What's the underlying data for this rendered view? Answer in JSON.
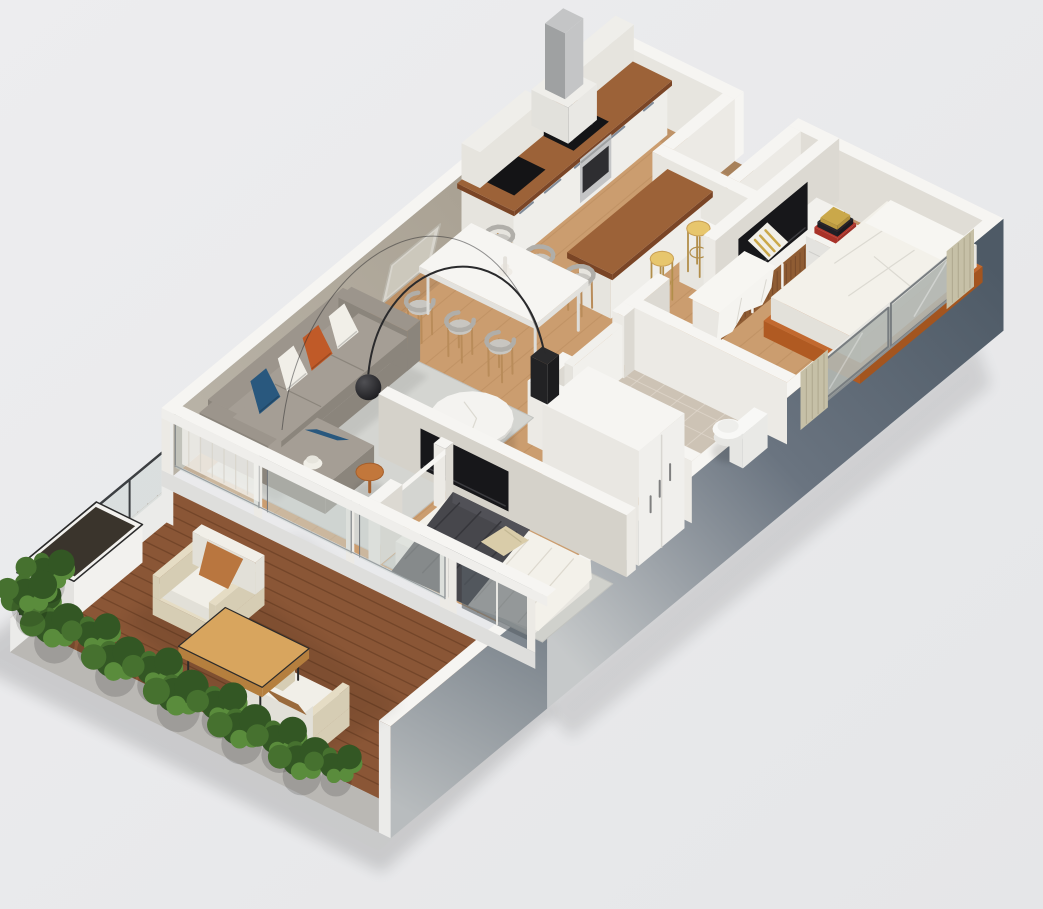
{
  "scene": {
    "title": "Isometric 3D floor plan render of a two-bedroom apartment with wooden terrace",
    "background": "#e8e9ea",
    "colors": {
      "bg1": "#ededef",
      "bg2": "#e5e6e8",
      "cap": "#f6f5f2",
      "beam": "#efeeeb",
      "wall_face_white": "#eceae5",
      "wall_face_warm": "#e7e5df",
      "wall_face_shade": "#e0ddd6",
      "wall_face_inner": "#dcd9d2",
      "tv_wall_face": "#d5d2ca",
      "wall_taupe_1": "#a49b8c",
      "wall_taupe_2": "#b8b2a6",
      "wall_grad_1": "#4e5a66",
      "wall_grad_2": "#6a7480",
      "wall_grad_3": "#c6c9ca",
      "ext_grad_1": "#5f6a75",
      "ext_grad_2": "#b8bcbe",
      "end_face": "#ebebe9",
      "floor_wood": "#cb9d6f",
      "floor_plank": "#b8895b",
      "tile": "#cdc3b5",
      "grout": "#ded6ca",
      "deck": "#8a5636",
      "deck_line": "#61391f",
      "deck_fascia": "#bab8b4",
      "rug_living": "#d4d5d1",
      "rug_bed": "#d0d1cc",
      "rug_edge": "#c2c3bf",
      "sofa": "#9c958c",
      "sofa_dark": "#8b857c",
      "sofa_seat": "#a59e95",
      "pillow_white": "#f1efe8",
      "pillow_orange": "#c05a28",
      "pillow_blue": "#29587e",
      "pillow_beige": "#d9cca9",
      "pillow_tan": "#b9763f",
      "pillow_brown": "#9a6a3c",
      "marble": "#f4f3f0",
      "marble_rim": "#d9d8d4",
      "side_table": "#c2773b",
      "lamp_dark": "#2a2a2c",
      "lamp_hi": "#505054",
      "lamp_lo": "#131316",
      "table_white": "#f6f5f2",
      "table_side": "#e2e1dd",
      "chair_shell": "#b0aea9",
      "chair_seat": "#c8c6c1",
      "leg_wood": "#b98c5a",
      "counter_wood": "#9c6238",
      "counter_dark": "#7a4526",
      "cabinet": "#efeeea",
      "cabinet_side": "#e6e4de",
      "handle": "#647284",
      "steel": "#c4c5c6",
      "steel_dark": "#9fa1a2",
      "appliance_black": "#141416",
      "stool": "#e7c66d",
      "stool_leg": "#b28e4a",
      "bed_white": "#f3f1ea",
      "bed_fold": "#dcdad2",
      "bed_frame": "#c2692f",
      "bed_frame_dark": "#a3551f",
      "blanket": "#47474c",
      "blanket_fold": "#36363b",
      "curtain": "#c6c0a7",
      "curtain_dark": "#aaa389",
      "window_glass": "#b2b6b1",
      "window_frame": "#787d80",
      "glass_pane": "rgba(202,212,209,0.48)",
      "glass_dark": "rgba(88,97,104,0.62)",
      "sheer": "rgba(246,245,241,0.72)",
      "sheer_line": "rgba(215,212,202,0.85)",
      "tv": "#17171a",
      "tv_sheen": "#3c3c40",
      "console_top": "#f2f1ed",
      "rattan": "#8f5c33",
      "rattan_line": "#6f4426",
      "nightstand": "#f4f3ef",
      "book_red": "#b5372c",
      "book_black": "#23232a",
      "book_yellow": "#caa84a",
      "toilet": "#f8f8f6",
      "toilet_shade": "#e6e6e3",
      "closet": "#f0efec",
      "closet_side": "#e9e7e2",
      "closet_handle": "#7f7f7f",
      "door": "#f1f0ec",
      "door_shade": "#dbd8d1",
      "planter": "#f2f1ee",
      "soil": "#3a342c",
      "outdoor_frame": "#e5dcc4",
      "outdoor_frame_side": "#d6cdb4",
      "outdoor_cushion": "#f1efe8",
      "outdoor_cushion_side": "#e2e0d8",
      "outdoor_table": "#d8a55e",
      "outdoor_table_side": "#b57f3e",
      "metal_dark": "#2b2b2b",
      "rail": "#3c3f42",
      "rail_glass": "rgba(195,205,202,0.4)",
      "green_1": "#46712f",
      "green_2": "#5a8c3c",
      "green_3": "#335724",
      "art_frame": "#d8d5cd",
      "art_inner": "#ccc8bc",
      "vase": "#efece6",
      "shadow": "#000000"
    },
    "rooms": [
      {
        "name": "kitchen",
        "items": [
          "cabinet-run",
          "range-hood",
          "cooktop",
          "oven",
          "sink",
          "upper-cabinets",
          "bar-counter",
          "bar-stools"
        ]
      },
      {
        "name": "dining-area",
        "items": [
          "dining-table",
          "dining-chairs",
          "vase"
        ]
      },
      {
        "name": "living-room",
        "items": [
          "sofa",
          "throw-pillows",
          "arc-floor-lamp",
          "round-coffee-table",
          "side-table",
          "area-rug",
          "wall-art"
        ]
      },
      {
        "name": "entry",
        "items": [
          "entry-alcove",
          "front-door"
        ]
      },
      {
        "name": "bedroom-1",
        "items": [
          "double-bed",
          "tv",
          "tv-console",
          "nightstand",
          "books",
          "curtains",
          "sliding-window"
        ]
      },
      {
        "name": "bathroom",
        "items": [
          "toilet",
          "bathroom-door",
          "tile-floor"
        ]
      },
      {
        "name": "hallway",
        "items": [
          "wardrobe"
        ]
      },
      {
        "name": "bedroom-2",
        "items": [
          "double-bed",
          "wall-tv",
          "area-rug",
          "sliding-glass-door"
        ]
      },
      {
        "name": "terrace",
        "items": [
          "wood-deck",
          "lounge-chairs",
          "outdoor-coffee-table",
          "planter-bench",
          "shrubs",
          "glass-railing"
        ]
      }
    ]
  }
}
